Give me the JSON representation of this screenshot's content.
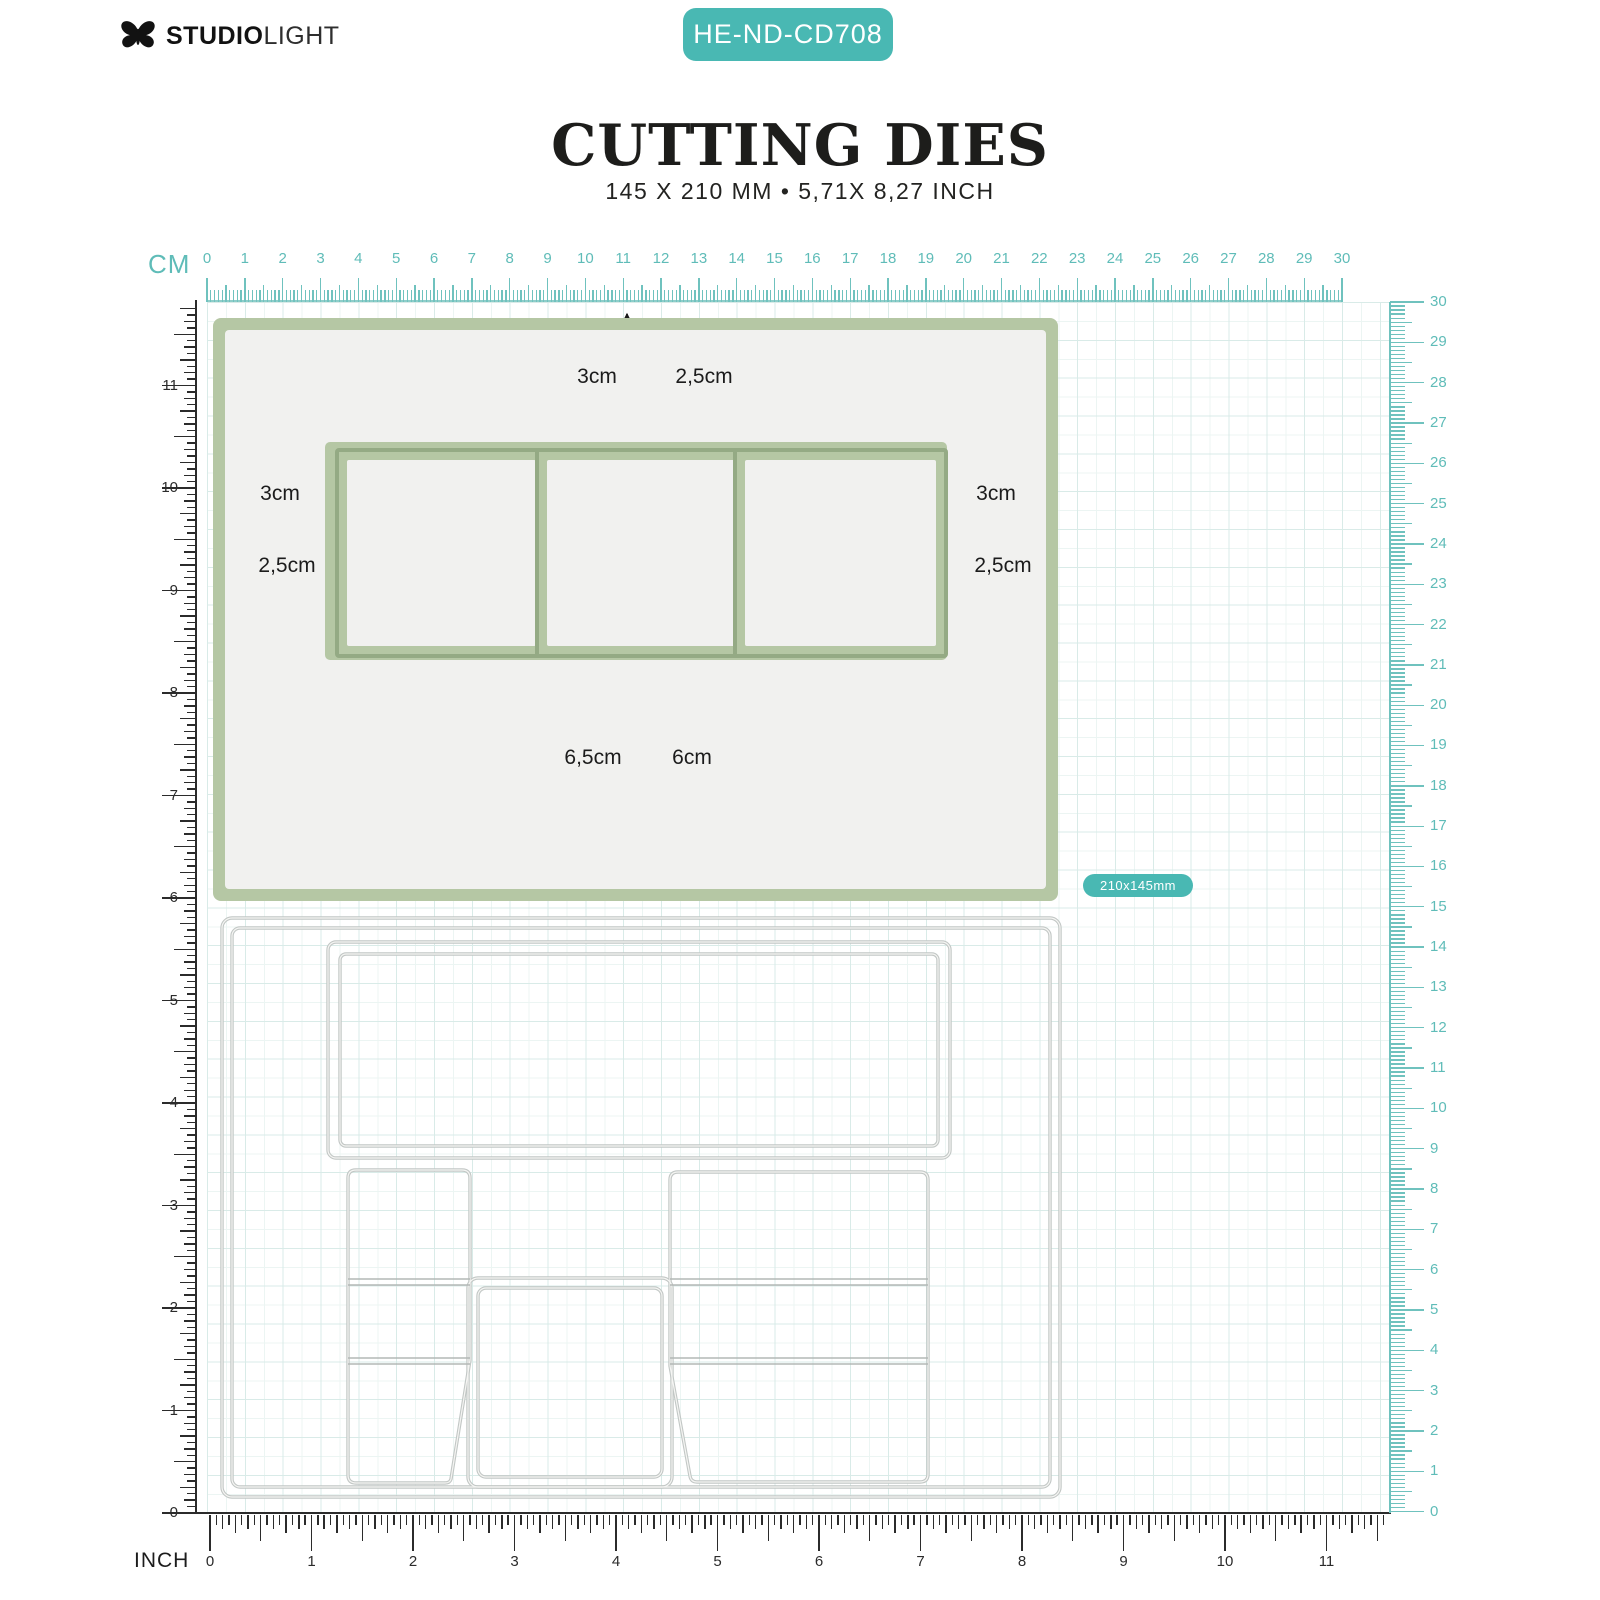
{
  "header": {
    "brand": {
      "part_bold": "STUDIO",
      "part_light": "LIGHT"
    },
    "sku_badge": "HE-ND-CD708",
    "title": "CUTTING DIES",
    "subtitle": "145 X 210 MM • 5,71X 8,27 INCH"
  },
  "colors": {
    "teal": "#49b8b3",
    "sage": "#b5c7a4",
    "sage_dark": "#94aa84",
    "die_outline": "#c6cac8"
  },
  "rulers": {
    "cm_label": "CM",
    "inch_label": "INCH",
    "cm_numbers": [
      "0",
      "1",
      "2",
      "3",
      "4",
      "5",
      "6",
      "7",
      "8",
      "9",
      "10",
      "11",
      "12",
      "13",
      "14",
      "15",
      "16",
      "17",
      "18",
      "19",
      "20",
      "21",
      "22",
      "23",
      "24",
      "25",
      "26",
      "27",
      "28",
      "29",
      "30"
    ],
    "inch_numbers": [
      "0",
      "1",
      "2",
      "3",
      "4",
      "5",
      "6",
      "7",
      "8",
      "9",
      "10",
      "11"
    ]
  },
  "size_badge": "210x145mm",
  "dimension_labels": {
    "top_outer": "3cm",
    "top_inner": "2,5cm",
    "left_outer": "3cm",
    "left_inner": "2,5cm",
    "right_outer": "3cm",
    "right_inner": "2,5cm",
    "bottom_outer": "6,5cm",
    "bottom_inner": "6cm"
  }
}
